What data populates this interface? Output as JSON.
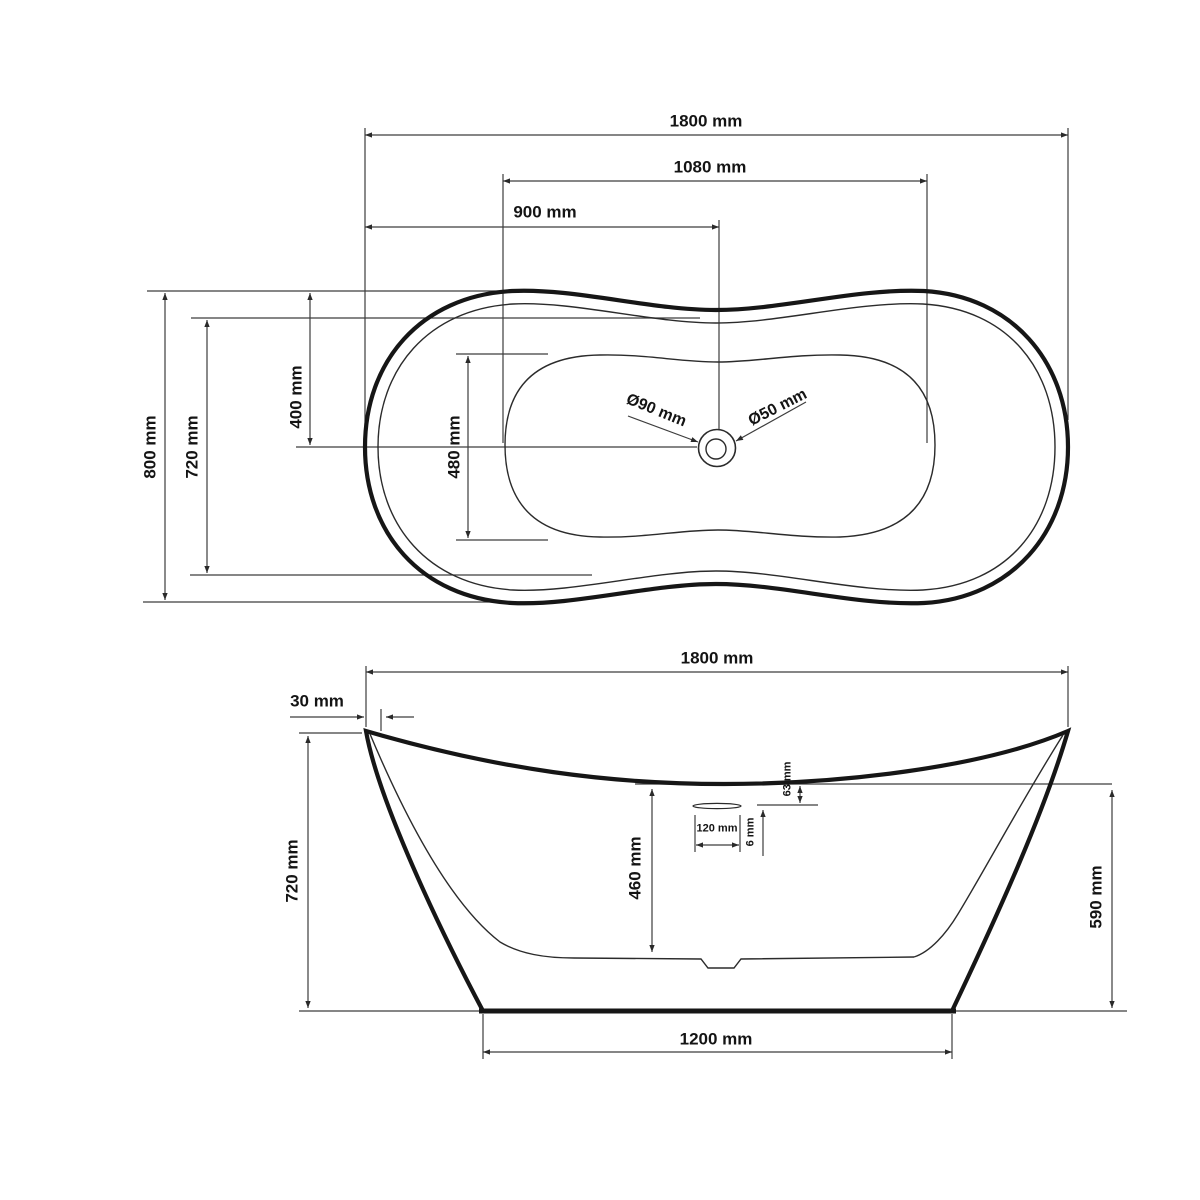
{
  "colors": {
    "line_thick": "#161616",
    "line_thin": "#2b2b2b",
    "line_dim": "#3d3d3d",
    "background": "#ffffff",
    "text": "#141414"
  },
  "top_view": {
    "length": "1800 mm",
    "basin_length": "1080 mm",
    "drain_from_left": "900 mm",
    "width": "800 mm",
    "inner_width": "720 mm",
    "edge_to_center": "400 mm",
    "basin_width": "480 mm",
    "drain_outer_dia": "Ø90 mm",
    "drain_inner_dia": "Ø50 mm"
  },
  "front_view": {
    "length": "1800 mm",
    "rim_thickness": "30 mm",
    "height": "720 mm",
    "inner_depth": "460 mm",
    "overflow_drop": "63 mm",
    "overflow_slot_height": "6 mm",
    "overflow_slot_width": "120 mm",
    "side_height": "590 mm",
    "base_length": "1200 mm"
  }
}
